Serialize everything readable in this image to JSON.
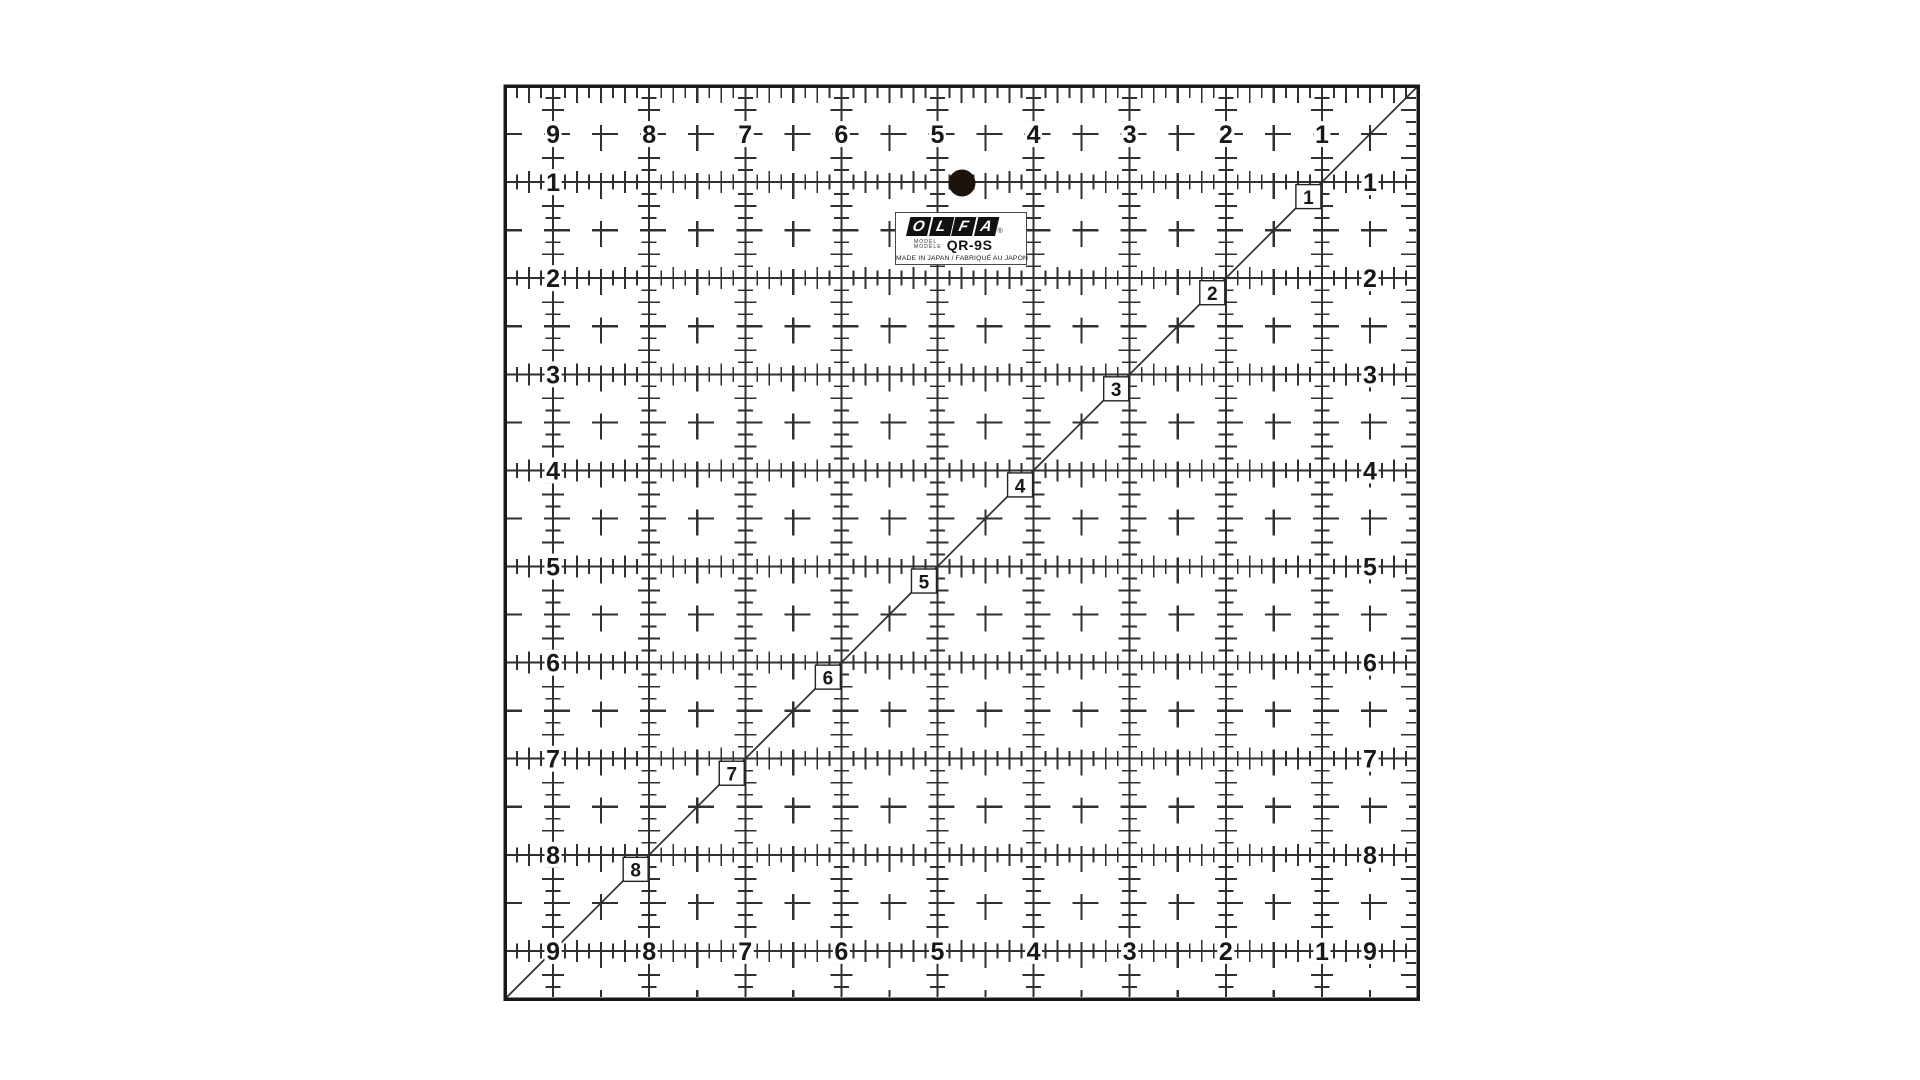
{
  "page": {
    "background": "#ffffff"
  },
  "ruler": {
    "colors": {
      "body": "#ffffff",
      "line": "#332f2d",
      "ink": "#1a1716",
      "hole": "#1c130c",
      "box_border": "#262220"
    },
    "label": {
      "brand_letters": [
        "O",
        "L",
        "F",
        "A"
      ],
      "registered": "®",
      "model_heading_en": "MODEL",
      "model_heading_fr": "MODÈLE",
      "model_number": "QR-9S",
      "origin_text": "MADE IN JAPAN / FABRIQUÉ AU JAPON"
    },
    "scales": {
      "top_numbers": [
        "9",
        "8",
        "7",
        "6",
        "5",
        "4",
        "3",
        "2",
        "1"
      ],
      "left_numbers": [
        "1",
        "2",
        "3",
        "4",
        "5",
        "6",
        "7",
        "8",
        "9"
      ],
      "right_numbers": [
        "1",
        "2",
        "3",
        "4",
        "5",
        "6",
        "7",
        "8",
        "9"
      ],
      "bottom_numbers": [
        "9",
        "8",
        "7",
        "6",
        "5",
        "4",
        "3",
        "2",
        "1"
      ],
      "bottom_right_corner_number": "9",
      "diagonal_numbers": [
        "1",
        "2",
        "3",
        "4",
        "5",
        "6",
        "7",
        "8"
      ]
    }
  }
}
